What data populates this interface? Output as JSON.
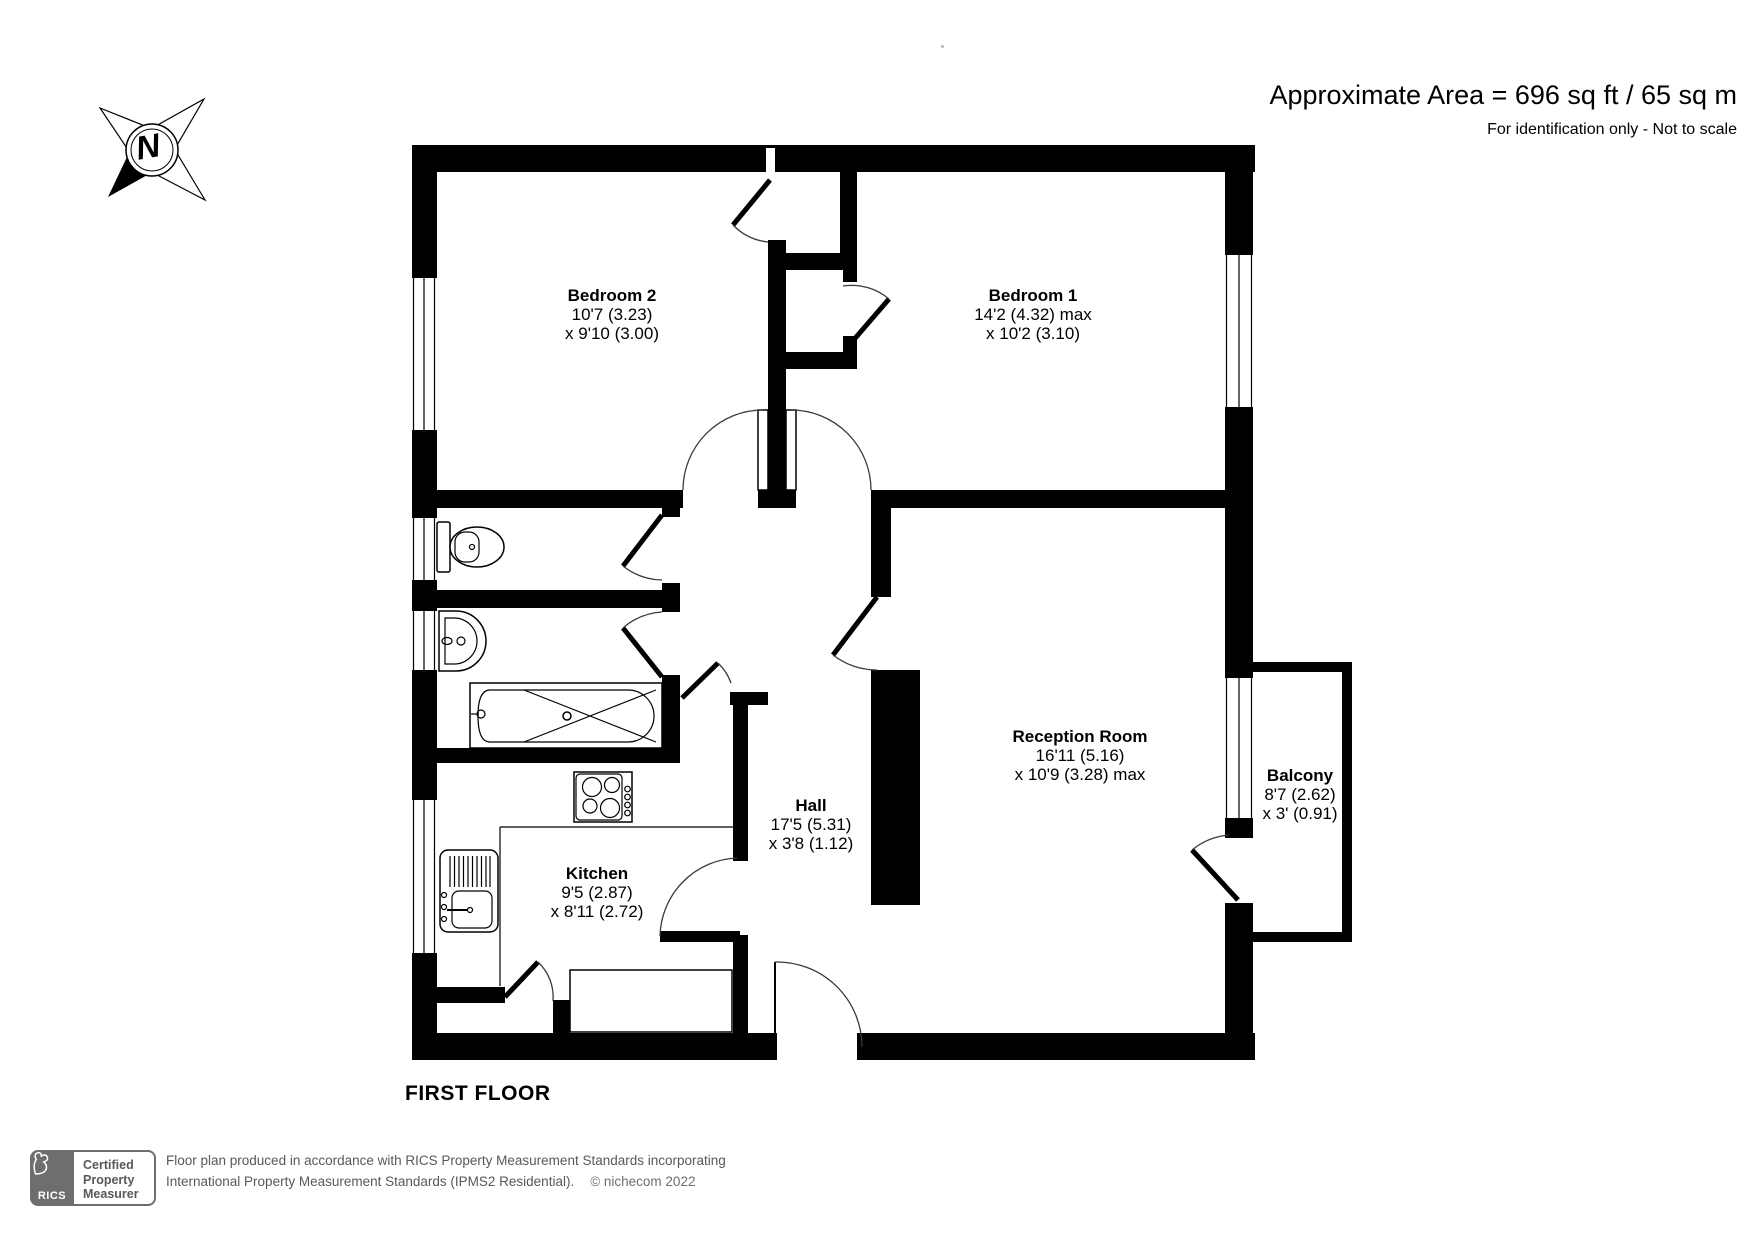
{
  "header": {
    "area": "Approximate Area = 696 sq ft / 65 sq m",
    "note": "For identification only - Not to scale"
  },
  "compass": {
    "north": "N"
  },
  "floor_label": "FIRST FLOOR",
  "rooms": [
    {
      "name": "Bedroom 2",
      "dim1": "10'7 (3.23)",
      "dim2": "x 9'10 (3.00)"
    },
    {
      "name": "Bedroom 1",
      "dim1": "14'2 (4.32) max",
      "dim2": "x 10'2 (3.10)"
    },
    {
      "name": "Reception Room",
      "dim1": "16'11 (5.16)",
      "dim2": "x 10'9 (3.28) max"
    },
    {
      "name": "Balcony",
      "dim1": "8'7 (2.62)",
      "dim2": "x 3' (0.91)"
    },
    {
      "name": "Hall",
      "dim1": "17'5 (5.31)",
      "dim2": "x 3'8 (1.12)"
    },
    {
      "name": "Kitchen",
      "dim1": "9'5 (2.87)",
      "dim2": "x 8'11 (2.72)"
    }
  ],
  "footer": {
    "rics": "RICS",
    "badge": [
      "Certified",
      "Property",
      "Measurer"
    ],
    "line1": "Floor plan produced in accordance with RICS Property Measurement Standards incorporating",
    "line2": "International Property Measurement Standards (IPMS2 Residential).",
    "copyright": "© nichecom 2022"
  },
  "colors": {
    "wall": "#000000",
    "footer_gray": "#58595b",
    "badge_gray": "#6d6e70"
  }
}
